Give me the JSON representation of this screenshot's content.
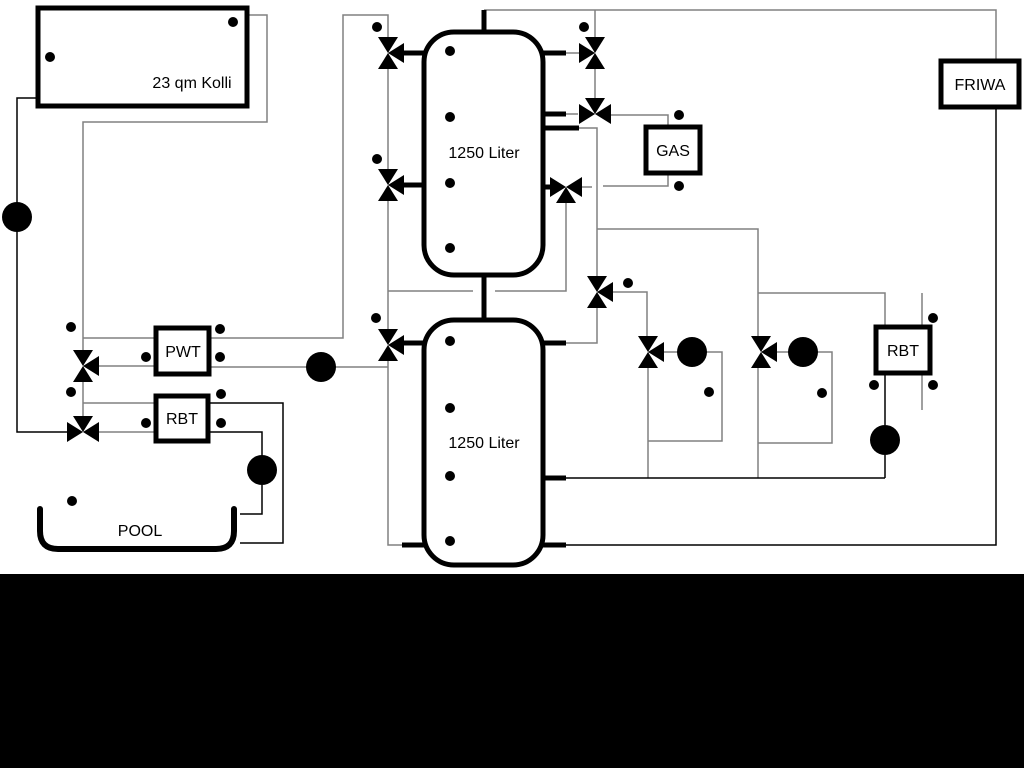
{
  "diagram": {
    "labels": {
      "collector": "23 qm Kolli",
      "tank_upper": "1250 Liter",
      "tank_lower": "1250 Liter",
      "gas": "GAS",
      "friwa": "FRIWA",
      "pwt": "PWT",
      "rbt_solar": "RBT",
      "rbt_dhw": "RBT",
      "pool": "POOL"
    },
    "colors": {
      "pipe_gray": "#808080",
      "pipe_black": "#000000",
      "background": "#ffffff",
      "footer_bar": "#000000"
    },
    "symbols": {
      "three_way_valve": "bowtie-valve-icon",
      "pump": "circle-triangle-pump-icon",
      "sensor": "temperature-sensor-icon"
    }
  }
}
